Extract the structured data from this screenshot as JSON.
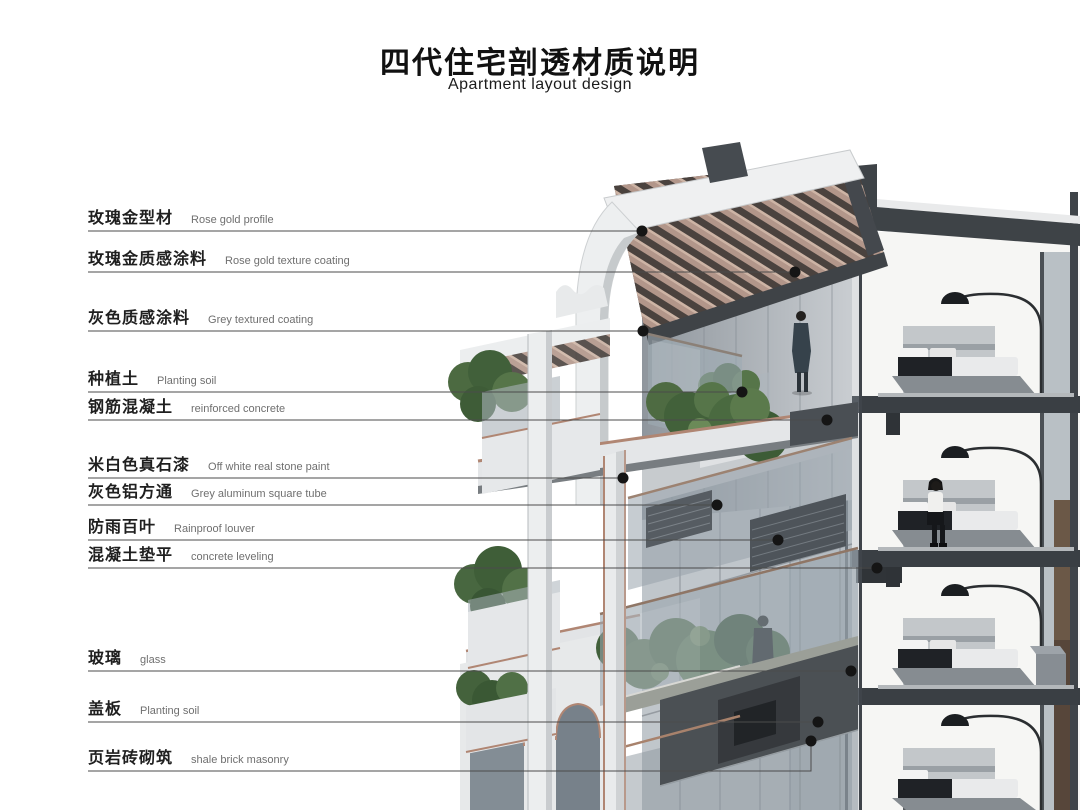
{
  "header": {
    "title_cn": "四代住宅剖透材质说明",
    "title_en": "Apartment layout design"
  },
  "legend": {
    "items": [
      {
        "cn": "玫瑰金型材",
        "en": "Rose gold profile"
      },
      {
        "cn": "玫瑰金质感涂料",
        "en": "Rose gold texture coating"
      },
      {
        "cn": "灰色质感涂料",
        "en": "Grey textured coating"
      },
      {
        "cn": "种植土",
        "en": "Planting soil"
      },
      {
        "cn": "钢筋混凝土",
        "en": "reinforced concrete"
      },
      {
        "cn": "米白色真石漆",
        "en": "Off white real stone paint"
      },
      {
        "cn": "灰色铝方通",
        "en": "Grey aluminum square tube"
      },
      {
        "cn": "防雨百叶",
        "en": "Rainproof louver"
      },
      {
        "cn": "混凝土垫平",
        "en": "concrete leveling"
      },
      {
        "cn": "玻璃",
        "en": "glass"
      },
      {
        "cn": "盖板",
        "en": "Planting soil"
      },
      {
        "cn": "页岩砖砌筑",
        "en": "shale brick masonry"
      }
    ]
  },
  "illustration": {
    "alt": "Cut-away 3D section rendering of a fourth-generation apartment building with wooden pergola roof, planted balconies, curved white columns and furnished bedroom interiors"
  },
  "colors": {
    "rose_gold_trim": "#b08673",
    "wood_slat": "#b2968a",
    "structure_dark": "#3e4347",
    "glass": "#9aa5ae",
    "plant_green": "#4c6a41",
    "facade_white": "#eceeef",
    "leader_line": "#4b4b4b",
    "dot": "#151515",
    "text_cn": "#1f1f1f",
    "text_en": "#6f6f6f"
  }
}
